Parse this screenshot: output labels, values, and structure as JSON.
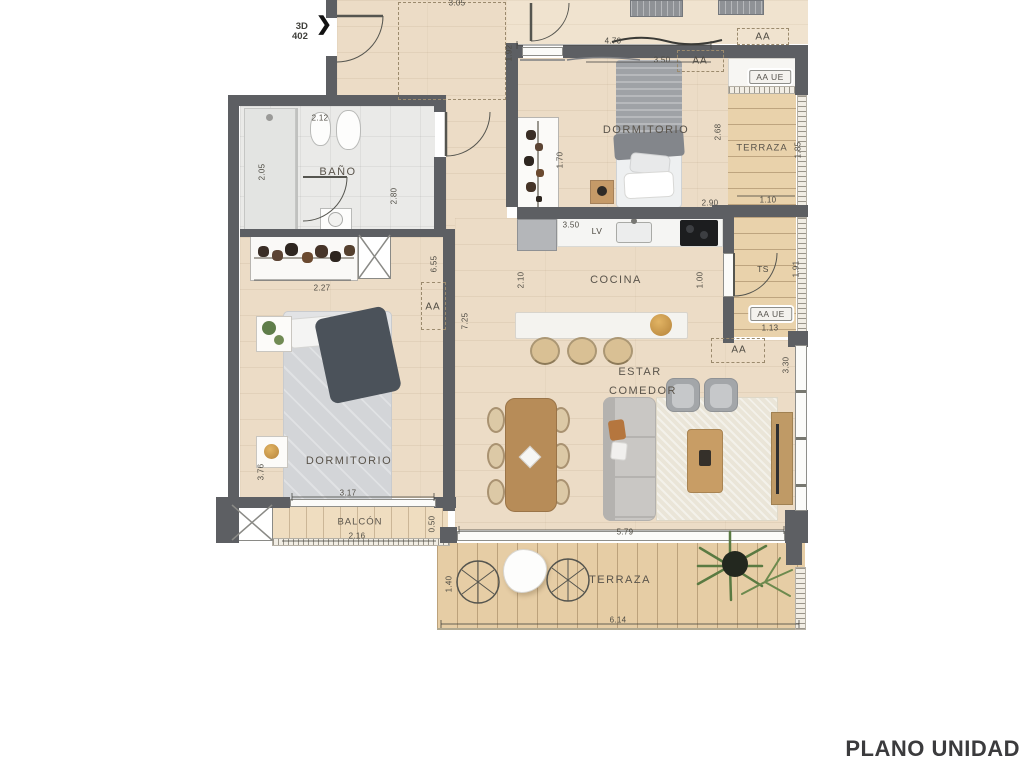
{
  "title": "PLANO UNIDAD",
  "marker": {
    "line1": "3D",
    "line2": "402",
    "arrow": "❯"
  },
  "colors": {
    "wall": "#5d5f63",
    "interior_floor": "#ecdcc6",
    "deck": "#e6cda5",
    "bath_tile": "#eaeae8",
    "furniture_wood": "#b88c58",
    "title_text": "#3b3b3d",
    "palm_green": "#5a7a42",
    "gold_accent": "#d09c44"
  },
  "plan": {
    "room_labels": [
      {
        "text": "BAÑO",
        "x": 338,
        "y": 172,
        "cls": "room"
      },
      {
        "text": "DORMITORIO",
        "x": 646,
        "y": 130,
        "cls": "room"
      },
      {
        "text": "TERRAZA",
        "x": 762,
        "y": 148,
        "cls": "small"
      },
      {
        "text": "COCINA",
        "x": 616,
        "y": 280,
        "cls": "room"
      },
      {
        "text": "LV",
        "x": 597,
        "y": 231,
        "cls": "tiny-label"
      },
      {
        "text": "TS",
        "x": 763,
        "y": 269,
        "cls": "tiny-label"
      },
      {
        "text": "ESTAR",
        "x": 640,
        "y": 372,
        "cls": "room"
      },
      {
        "text": "COMEDOR",
        "x": 643,
        "y": 391,
        "cls": "room"
      },
      {
        "text": "DORMITORIO",
        "x": 349,
        "y": 461,
        "cls": "room"
      },
      {
        "text": "BALCÓN",
        "x": 360,
        "y": 522,
        "cls": "small"
      },
      {
        "text": "TERRAZA",
        "x": 620,
        "y": 580,
        "cls": "room"
      },
      {
        "text": "AA",
        "x": 763,
        "y": 37,
        "cls": "aa"
      },
      {
        "text": "AA",
        "x": 700,
        "y": 61,
        "cls": "aa"
      },
      {
        "text": "AA",
        "x": 433,
        "y": 307,
        "cls": "aa"
      },
      {
        "text": "AA",
        "x": 739,
        "y": 350,
        "cls": "aa"
      },
      {
        "text": "AA UE",
        "x": 770,
        "y": 77,
        "cls": "aaue"
      },
      {
        "text": "AA UE",
        "x": 771,
        "y": 314,
        "cls": "aaue"
      }
    ],
    "dimensions": [
      {
        "text": "3.05",
        "x": 457,
        "y": 3,
        "v": false
      },
      {
        "text": "1.92",
        "x": 509,
        "y": 53,
        "v": true
      },
      {
        "text": "4.70",
        "x": 613,
        "y": 41,
        "v": false
      },
      {
        "text": "3.50",
        "x": 662,
        "y": 60,
        "v": false
      },
      {
        "text": "2.68",
        "x": 718,
        "y": 132,
        "v": true
      },
      {
        "text": "2.90",
        "x": 710,
        "y": 203,
        "v": false
      },
      {
        "text": "1.85",
        "x": 798,
        "y": 150,
        "v": true
      },
      {
        "text": "1.10",
        "x": 768,
        "y": 200,
        "v": false
      },
      {
        "text": "1.70",
        "x": 560,
        "y": 160,
        "v": true
      },
      {
        "text": "2.12",
        "x": 320,
        "y": 118,
        "v": false
      },
      {
        "text": "2.05",
        "x": 262,
        "y": 172,
        "v": true
      },
      {
        "text": "2.80",
        "x": 394,
        "y": 196,
        "v": true
      },
      {
        "text": "2.27",
        "x": 322,
        "y": 288,
        "v": false
      },
      {
        "text": "6.55",
        "x": 434,
        "y": 264,
        "v": true
      },
      {
        "text": "7.25",
        "x": 465,
        "y": 321,
        "v": true
      },
      {
        "text": "3.50",
        "x": 571,
        "y": 225,
        "v": false
      },
      {
        "text": "2.10",
        "x": 521,
        "y": 280,
        "v": true
      },
      {
        "text": "1.00",
        "x": 700,
        "y": 280,
        "v": true
      },
      {
        "text": "1.91",
        "x": 796,
        "y": 269,
        "v": true
      },
      {
        "text": "1.13",
        "x": 770,
        "y": 328,
        "v": false
      },
      {
        "text": "3.30",
        "x": 786,
        "y": 365,
        "v": true
      },
      {
        "text": "3.76",
        "x": 261,
        "y": 472,
        "v": true
      },
      {
        "text": "3.17",
        "x": 348,
        "y": 493,
        "v": false
      },
      {
        "text": "2.16",
        "x": 357,
        "y": 536,
        "v": false
      },
      {
        "text": "0.50",
        "x": 432,
        "y": 524,
        "v": true
      },
      {
        "text": "5.79",
        "x": 625,
        "y": 532,
        "v": false
      },
      {
        "text": "1.40",
        "x": 449,
        "y": 584,
        "v": true
      },
      {
        "text": "6.14",
        "x": 618,
        "y": 620,
        "v": false
      }
    ]
  }
}
